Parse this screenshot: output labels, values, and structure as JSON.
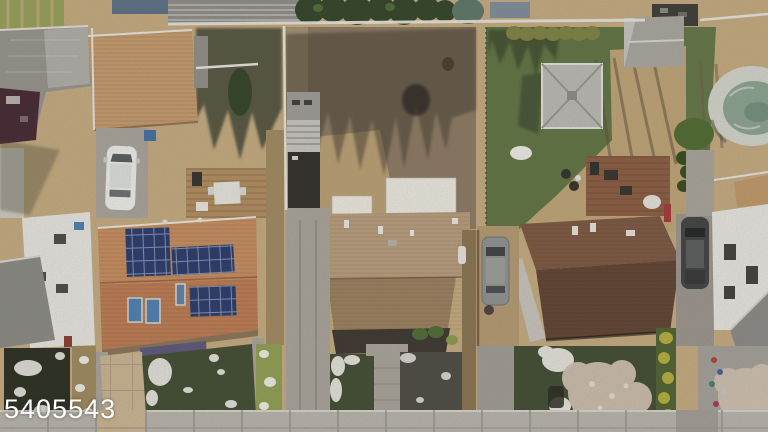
{
  "watermark": {
    "text": "5405543"
  },
  "scene": {
    "description": "Aerial drone photo of a residential block: four backyards and houses between a rear fence line and the street sidewalk",
    "objects": [
      "gray-roof-house-left",
      "tan-garage-roof",
      "white-car-in-driveway",
      "wood-deck-with-patio-table",
      "solar-panel-house-orange-roof",
      "skylights",
      "bare-dirt-backyard",
      "tree-shadows",
      "gray-shed",
      "white-garage-roof",
      "tan-shingle-house",
      "green-backyard",
      "hip-roof-gazebo",
      "gable-shed",
      "red-brown-deck",
      "dark-brown-roof-house",
      "gray-suv",
      "dark-suv",
      "above-ground-pool-with-cover",
      "white-siding-house-right",
      "leafless-tree-canopies",
      "snow-patches",
      "front-lawns",
      "concrete-driveways",
      "sidewalk",
      "white-rear-fence",
      "evergreen-trees"
    ]
  },
  "palette": {
    "dryGrass": "#c6ac80",
    "dirt": "#8c7962",
    "dirtLight": "#c0a577",
    "lawn": "#5e7342",
    "lawnDark": "#3f4a31",
    "lawnShadow": "#272c1e",
    "concrete": "#a9a59d",
    "sidewalk": "#b9b6af",
    "paver": "#ccb693",
    "roofGarageTan": "#c89c6d",
    "roofSolarTop": "#c98e60",
    "roofSolarFront": "#bf7c52",
    "solarPanel": "#26386c",
    "skylightBlue": "#4d7fb5",
    "roofGrayA": "#96948d",
    "whiteSiding": "#eae9e3",
    "maroon": "#432530",
    "deckWood": "#b28d5f",
    "roofCTop": "#ba9e7d",
    "roofCFront": "#9d805f",
    "porchDark": "#39342d",
    "whiteRoof": "#eeece3",
    "shedGray": "#9e9d97",
    "roofDTop": "#7d5740",
    "roofDFront": "#5f4231",
    "deckRed": "#8b5b41",
    "poolRing": "#d5d7ce",
    "poolCover": "#8ba491",
    "snow": "#f0efe9",
    "fenceWhite": "#eae8e0",
    "carWhite": "#eff1ee",
    "suvGray": "#909391",
    "suvDark": "#3e4041",
    "canopy": "#d4c5b6",
    "purpleAwning": "#5c5479",
    "bushOlive": "#7d8241",
    "hedge": "#4d6131",
    "hedgeYellow": "#c9bd3f",
    "treeDark": "#2f4226",
    "treeBlue": "#5c7668",
    "garden": "#97a158",
    "equipDark": "#3a3a36"
  }
}
